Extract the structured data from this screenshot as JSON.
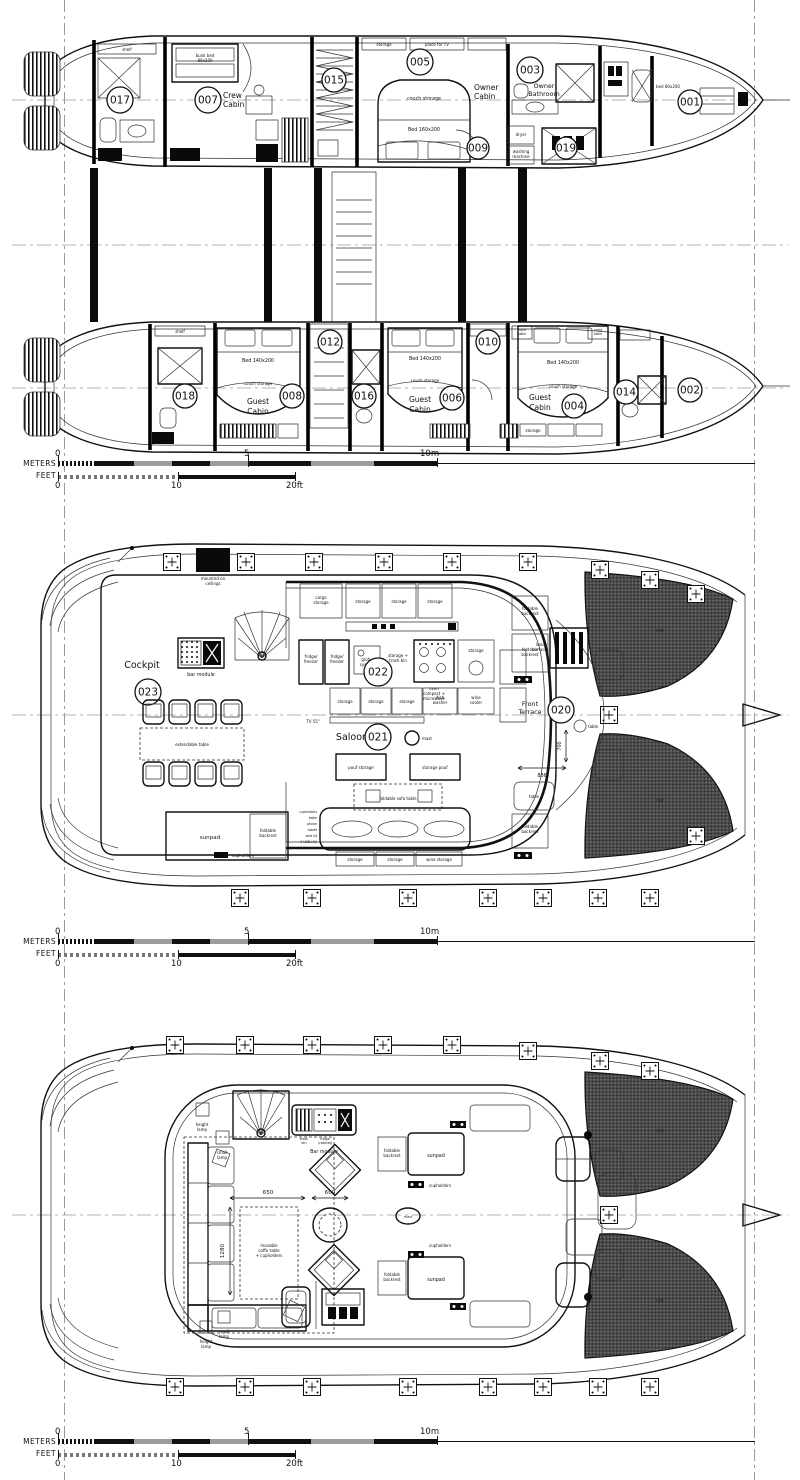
{
  "scalebar": {
    "meters": "METERS",
    "feet": "FEET",
    "m0": "0",
    "m5": "5",
    "m10": "10m",
    "f0": "0",
    "f10": "10",
    "f20": "20ft"
  },
  "deck1": {
    "n017": "017",
    "n007": "007",
    "crew1": "Crew",
    "crew2": "Cabin",
    "n015": "015",
    "n005": "005",
    "owner1": "Owner",
    "owner2": "Cabin",
    "n003": "003",
    "ob1": "Owner",
    "ob2": "Bathroom",
    "n009": "009",
    "n019": "019",
    "n001": "001",
    "n018": "018",
    "n008": "008",
    "g1": "Guest",
    "g2": "Cabin",
    "n012": "012",
    "n016": "016",
    "n006": "006",
    "n010": "010",
    "n004": "004",
    "n014": "014",
    "n002": "002",
    "shelf": "shelf",
    "bunk1": "bunk bed",
    "bunk2": "80x200",
    "couch": "couch storage",
    "bed160": "Bed 160x200",
    "tv": "place for TV",
    "storage": "storage",
    "dryer": "dryer",
    "wash1": "washing",
    "wash2": "machine",
    "bed80": "bed 80x200",
    "bed140": "Bed 140x200",
    "night1": "night",
    "night2": "table"
  },
  "deck2": {
    "cockpit": "Cockpit",
    "n023": "023",
    "bar": "bar module",
    "ceil1": "mounted on",
    "ceil2": "ceilings",
    "ext": "extendable table",
    "cargo1": "cargo",
    "cargo2": "storage",
    "storage": "storage",
    "fr1": "fridge/",
    "fr2": "freezer",
    "gr1": "grohe",
    "gr2": "system",
    "tb1": "storage +",
    "tb2": "trash bin",
    "ov1": "oven",
    "ov2": "compact +",
    "ov3": "microwave",
    "dw1": "dish",
    "dw2": "washer",
    "wc1": "wine",
    "wc2": "cooler",
    "tv": "TV 55\"",
    "n022": "022",
    "saloon": "Saloon",
    "n021": "021",
    "mast": "mast",
    "pouf1": "pouf storage",
    "pouf2": "storage pouf",
    "sofatable": "foldable sofa table",
    "side": [
      "cupholders",
      "table",
      "phone",
      "tablet",
      "sofa lid",
      "2 USB+AC"
    ],
    "wines": "wine storage",
    "sunpad": "sunpad",
    "fb1": "foldable",
    "fb2": "backrest",
    "cuph": "cupholders",
    "lu1": "lunch",
    "lu2": "surface",
    "ft1": "Front",
    "ft2": "Terrace",
    "n020": "020",
    "table": "table",
    "d700": "700",
    "d886": "886",
    "net": "net"
  },
  "deck3": {
    "hl1": "height",
    "hl2": "lamp",
    "sl1": "small",
    "sl2": "lamp",
    "bar": "Bar module",
    "tr1": "trash",
    "tr2": "bin",
    "fg1": "fridge",
    "fg2": "(cabinet)",
    "d650": "650",
    "d600": "600",
    "d1280": "1280",
    "mv1": "movable",
    "mv2": "coffe table",
    "mv3": "+ cupholders",
    "fb1": "foldable",
    "fb2": "backrest",
    "sunpad": "sunpad",
    "cuph": "cupholders",
    "mast": "mast",
    "net": "net"
  }
}
